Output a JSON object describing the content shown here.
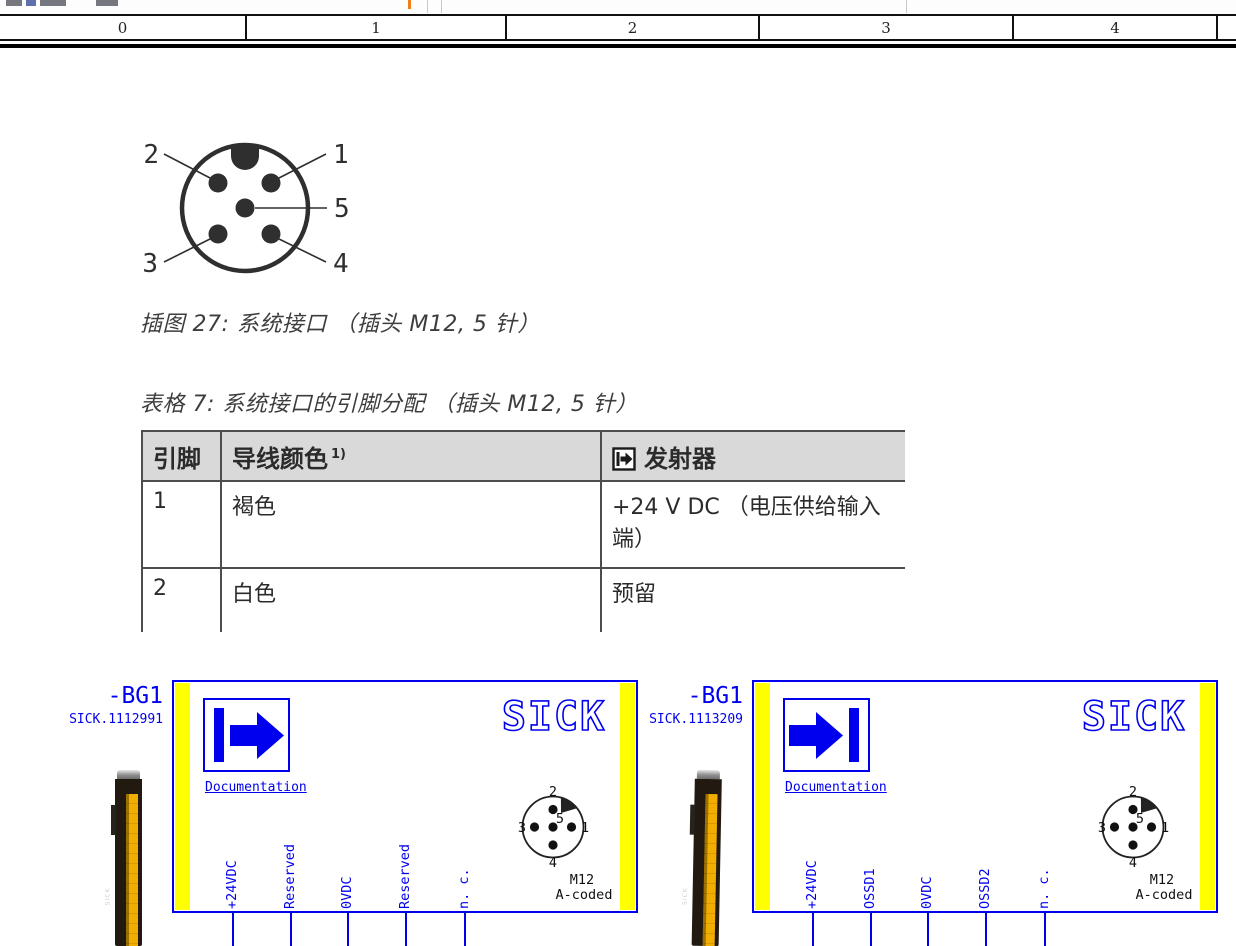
{
  "colors": {
    "accent_blue": "#0000ee",
    "highlight_yellow": "#ffff00",
    "table_header_bg": "#d9d9d9",
    "toolbar_mark_orange": "#f08018"
  },
  "ruler": {
    "cells": [
      "0",
      "1",
      "2",
      "3",
      "4"
    ]
  },
  "document": {
    "figure": {
      "caption": "插图 27: 系统接口 （插头 M12, 5 针）",
      "pin_labels": {
        "p1": "1",
        "p2": "2",
        "p3": "3",
        "p4": "4",
        "p5": "5"
      }
    },
    "table": {
      "caption": "表格 7: 系统接口的引脚分配 （插头 M12, 5 针）",
      "col_pin": "引脚",
      "col_color": "导线颜色",
      "col_color_note": "1)",
      "col_transmitter": "发射器",
      "rows": [
        {
          "pin": "1",
          "color": "褐色",
          "signal": "+24 V DC （电压供给输入端）"
        },
        {
          "pin": "2",
          "color": "白色",
          "signal": "预留"
        }
      ]
    }
  },
  "schematic": {
    "left_device": {
      "ref": "-BG1",
      "part": "SICK.1112991",
      "brand_logo": "SICK",
      "doc_link": "Documentation",
      "photo_label": "SICK",
      "pins": [
        "+24VDC",
        "Reserved",
        "0VDC",
        "Reserved",
        "n. c."
      ],
      "connector": {
        "label_top": "2",
        "label_left": "3",
        "label_center": "5",
        "label_right": "1",
        "label_bottom": "4",
        "type": "M12",
        "coding": "A-coded"
      }
    },
    "right_device": {
      "ref": "-BG1",
      "part": "SICK.1113209",
      "brand_logo": "SICK",
      "doc_link": "Documentation",
      "photo_label": "SICK",
      "pins": [
        "+24VDC",
        "OSSD1",
        "0VDC",
        "OSSD2",
        "n. c."
      ],
      "connector": {
        "label_top": "2",
        "label_left": "3",
        "label_center": "5",
        "label_right": "1",
        "label_bottom": "4",
        "type": "M12",
        "coding": "A-coded"
      }
    }
  }
}
